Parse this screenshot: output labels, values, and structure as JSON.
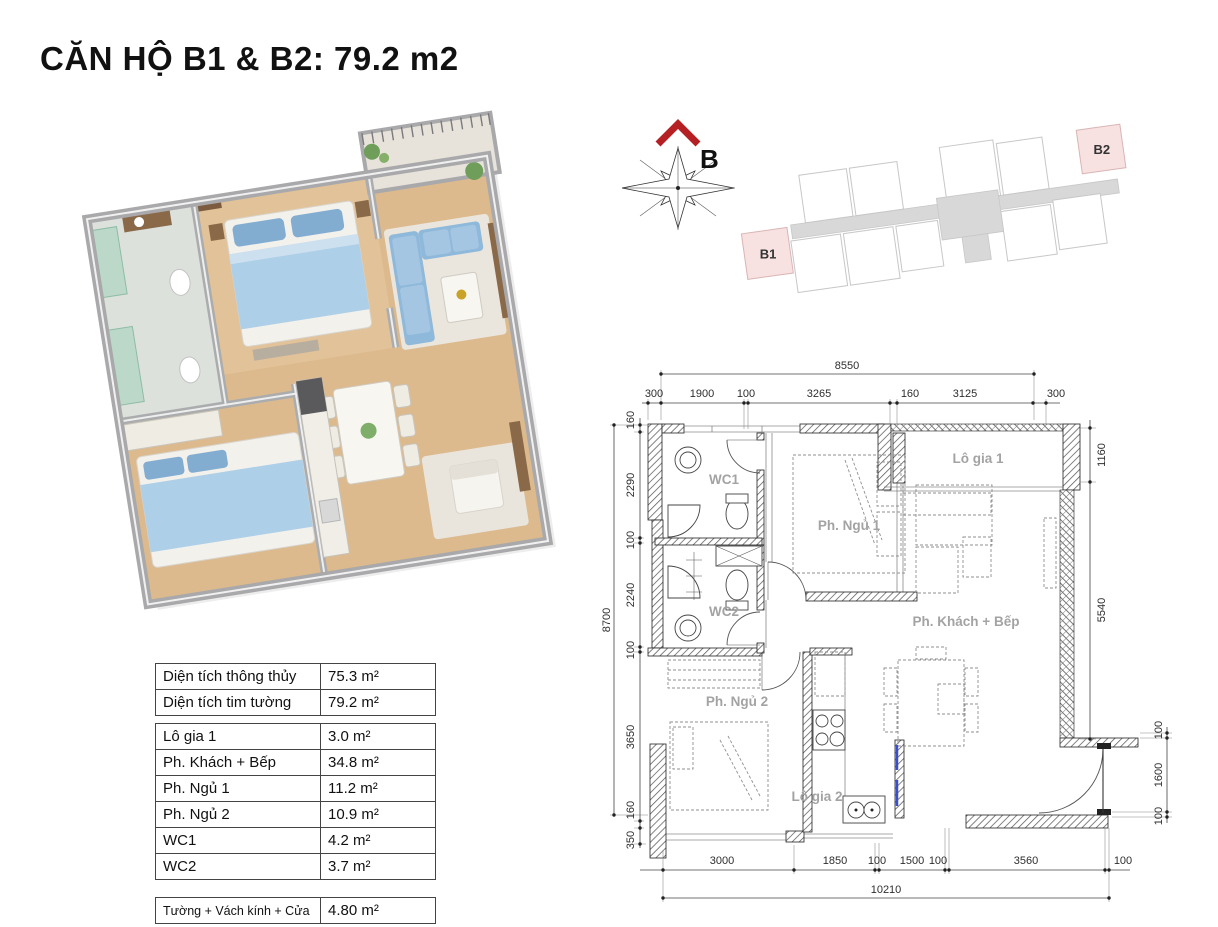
{
  "title": "CĂN HỘ B1 & B2: 79.2 m2",
  "colors": {
    "accent_red": "#b52025",
    "unit_highlight_pink": "#f7e1e1",
    "wood_floor": "#dcba8e",
    "wall_gray": "#a9a9ab",
    "bed_blue": "#aecfe8",
    "plan_label_gray": "#a3a3a3"
  },
  "compass": {
    "direction_label": "B"
  },
  "site_plan": {
    "unit_b1_label": "B1",
    "unit_b2_label": "B2"
  },
  "floor_plan": {
    "room_labels": {
      "wc1": "WC1",
      "wc2": "WC2",
      "bedroom1": "Ph. Ngủ 1",
      "bedroom2": "Ph. Ngủ 2",
      "living_kitchen": "Ph. Khách + Bếp",
      "balcony1": "Lô gia 1",
      "balcony2": "Lô gia 2"
    },
    "dimensions": {
      "top_total": "8550",
      "top_chain": [
        "300",
        "1900",
        "100",
        "3265",
        "160",
        "3125",
        "300"
      ],
      "bottom_chain": [
        "3000",
        "1850",
        "100",
        "1500",
        "100",
        "3560",
        "100"
      ],
      "bottom_total": "10210",
      "left_total": "8700",
      "left_chain": [
        "160",
        "2290",
        "100",
        "2240",
        "100",
        "3650",
        "160",
        "350"
      ],
      "right_chain_upper": [
        "1160",
        "5540"
      ],
      "right_chain_lower": [
        "100",
        "1600",
        "100"
      ]
    }
  },
  "area_table": {
    "summary_rows": [
      {
        "label": "Diện tích thông thủy",
        "value": "75.3 m²"
      },
      {
        "label": "Diện tích tim tường",
        "value": "79.2 m²"
      }
    ],
    "room_rows": [
      {
        "label": "Lô gia 1",
        "value": "3.0 m²"
      },
      {
        "label": "Ph. Khách + Bếp",
        "value": "34.8 m²"
      },
      {
        "label": "Ph. Ngủ 1",
        "value": "11.2 m²"
      },
      {
        "label": "Ph. Ngủ 2",
        "value": "10.9 m²"
      },
      {
        "label": "WC1",
        "value": "4.2 m²"
      },
      {
        "label": "WC2",
        "value": "3.7 m²"
      }
    ],
    "extra_rows": [
      {
        "label": "Tường + Vách kính + Cửa",
        "value": "4.80 m²"
      }
    ]
  }
}
